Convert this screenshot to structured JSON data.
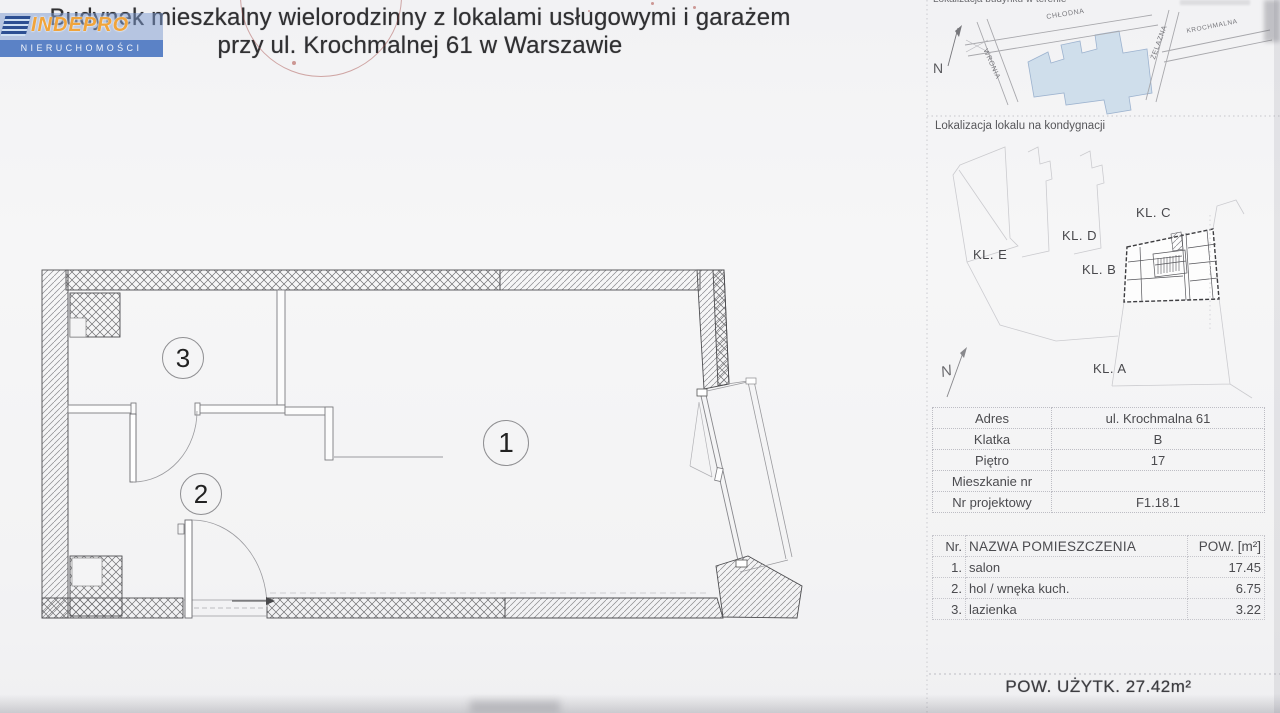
{
  "document": {
    "title_line1": "Budynek mieszkalny wielorodzinny z lokalami usługowymi i garażem",
    "title_line2": "przy ul. Krochmalnej 61 w Warszawie"
  },
  "logo": {
    "name": "INDEPRO",
    "subtitle": "NIERUCHOMOŚCI",
    "brand_blue": "#5b82c6",
    "brand_orange": "#f0a43c"
  },
  "site_map": {
    "label": "Lokalizacja budynku w terenie",
    "north_label": "N",
    "streets": [
      "CHŁODNA",
      "WRONIA",
      "ŻELAZNA",
      "KROCHMALNA"
    ],
    "building_fill": "#cfdeeb"
  },
  "floor_location": {
    "label": "Lokalizacja lokalu na kondygnacji",
    "north_label": "N",
    "staircases": [
      "KL. C",
      "KL. D",
      "KL. E",
      "KL. B",
      "KL. A"
    ]
  },
  "unit_info": {
    "rows": [
      {
        "label": "Adres",
        "value": "ul. Krochmalna 61"
      },
      {
        "label": "Klatka",
        "value": "B"
      },
      {
        "label": "Piętro",
        "value": "17"
      },
      {
        "label": "Mieszkanie nr",
        "value": ""
      },
      {
        "label": "Nr projektowy",
        "value": "F1.18.1"
      }
    ]
  },
  "rooms_table": {
    "header_nr": "Nr.",
    "header_name": "NAZWA POMIESZCZENIA",
    "header_area": "POW. [m²]",
    "rows": [
      {
        "nr": "1.",
        "name": "salon",
        "area": "17.45"
      },
      {
        "nr": "2.",
        "name": "hol / wnęka kuch.",
        "area": "6.75"
      },
      {
        "nr": "3.",
        "name": "lazienka",
        "area": "3.22"
      }
    ],
    "total_label": "POW. UŻYTK. 27.42m²"
  },
  "floor_plan": {
    "room_markers": [
      "1",
      "2",
      "3"
    ]
  }
}
